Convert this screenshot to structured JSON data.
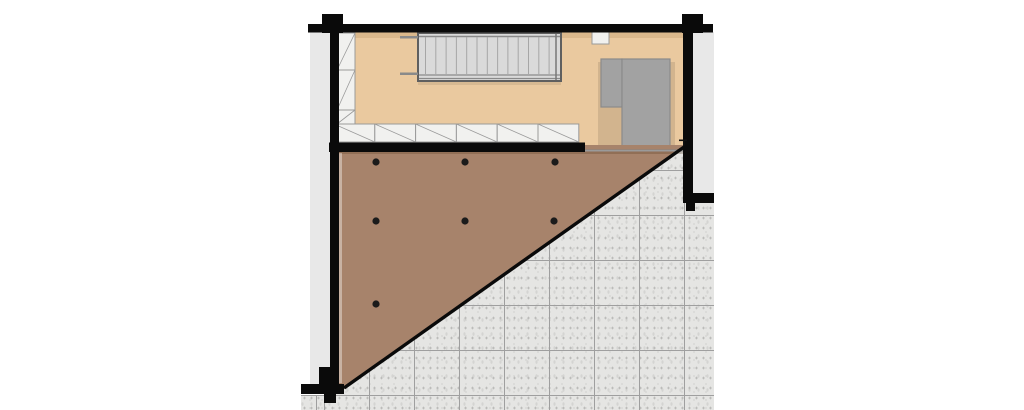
{
  "title": "floor-plan-upper-level",
  "colors": {
    "background": "#ffffff",
    "wall": "#0a0a0a",
    "exterior_strip": "#e8e8e8",
    "room_floor": "#eac99f",
    "room_shade": "rgba(130,85,35,0.15)",
    "deck": "#a7836b",
    "deck_shade": "rgba(70,40,15,0.22)",
    "deck_edge_highlight": "rgba(255,255,255,0.38)",
    "deck_dot": "#1b1b1b",
    "diagonal_edge": "#0a0a0a",
    "boundary_line": "#9a9a9a",
    "tile_base": "#e5e5e3",
    "tile_grid": "#9f9f9f",
    "cabinet_fill": "#f1f1ef",
    "cabinet_line": "#9a9a9a",
    "stair_fill": "#dadada",
    "stair_frame": "#5f5f5f",
    "stair_tread": "#a6a6a6",
    "stair_rail": "#8a8a8a",
    "furniture_fill": "#a2a2a2",
    "furniture_border": "#8a8a8a",
    "furniture_shadow": "rgba(0,0,0,0.10)",
    "niche_fill": "#f1f1ef"
  },
  "terrace": {
    "tile_size_px": 45
  },
  "deck": {
    "dot_radius": 3.6,
    "dots": [
      [
        376,
        162
      ],
      [
        465,
        162
      ],
      [
        555,
        162
      ],
      [
        376,
        221
      ],
      [
        465,
        221
      ],
      [
        554,
        221
      ],
      [
        376,
        304
      ]
    ]
  },
  "staircase": {
    "tread_count": 13,
    "tread_x0": 425.5,
    "tread_dx": 10.3,
    "tread_y1": 37,
    "tread_y2": 74
  },
  "cabinets": {
    "bottom_row": {
      "count": 6,
      "x0": 334,
      "y": 124,
      "cell_w": 40.8,
      "h": 18
    },
    "left_column": {
      "x": 337,
      "w": 18,
      "cells_y": [
        33,
        70,
        110
      ],
      "cells_h": [
        37,
        40,
        14
      ]
    }
  }
}
